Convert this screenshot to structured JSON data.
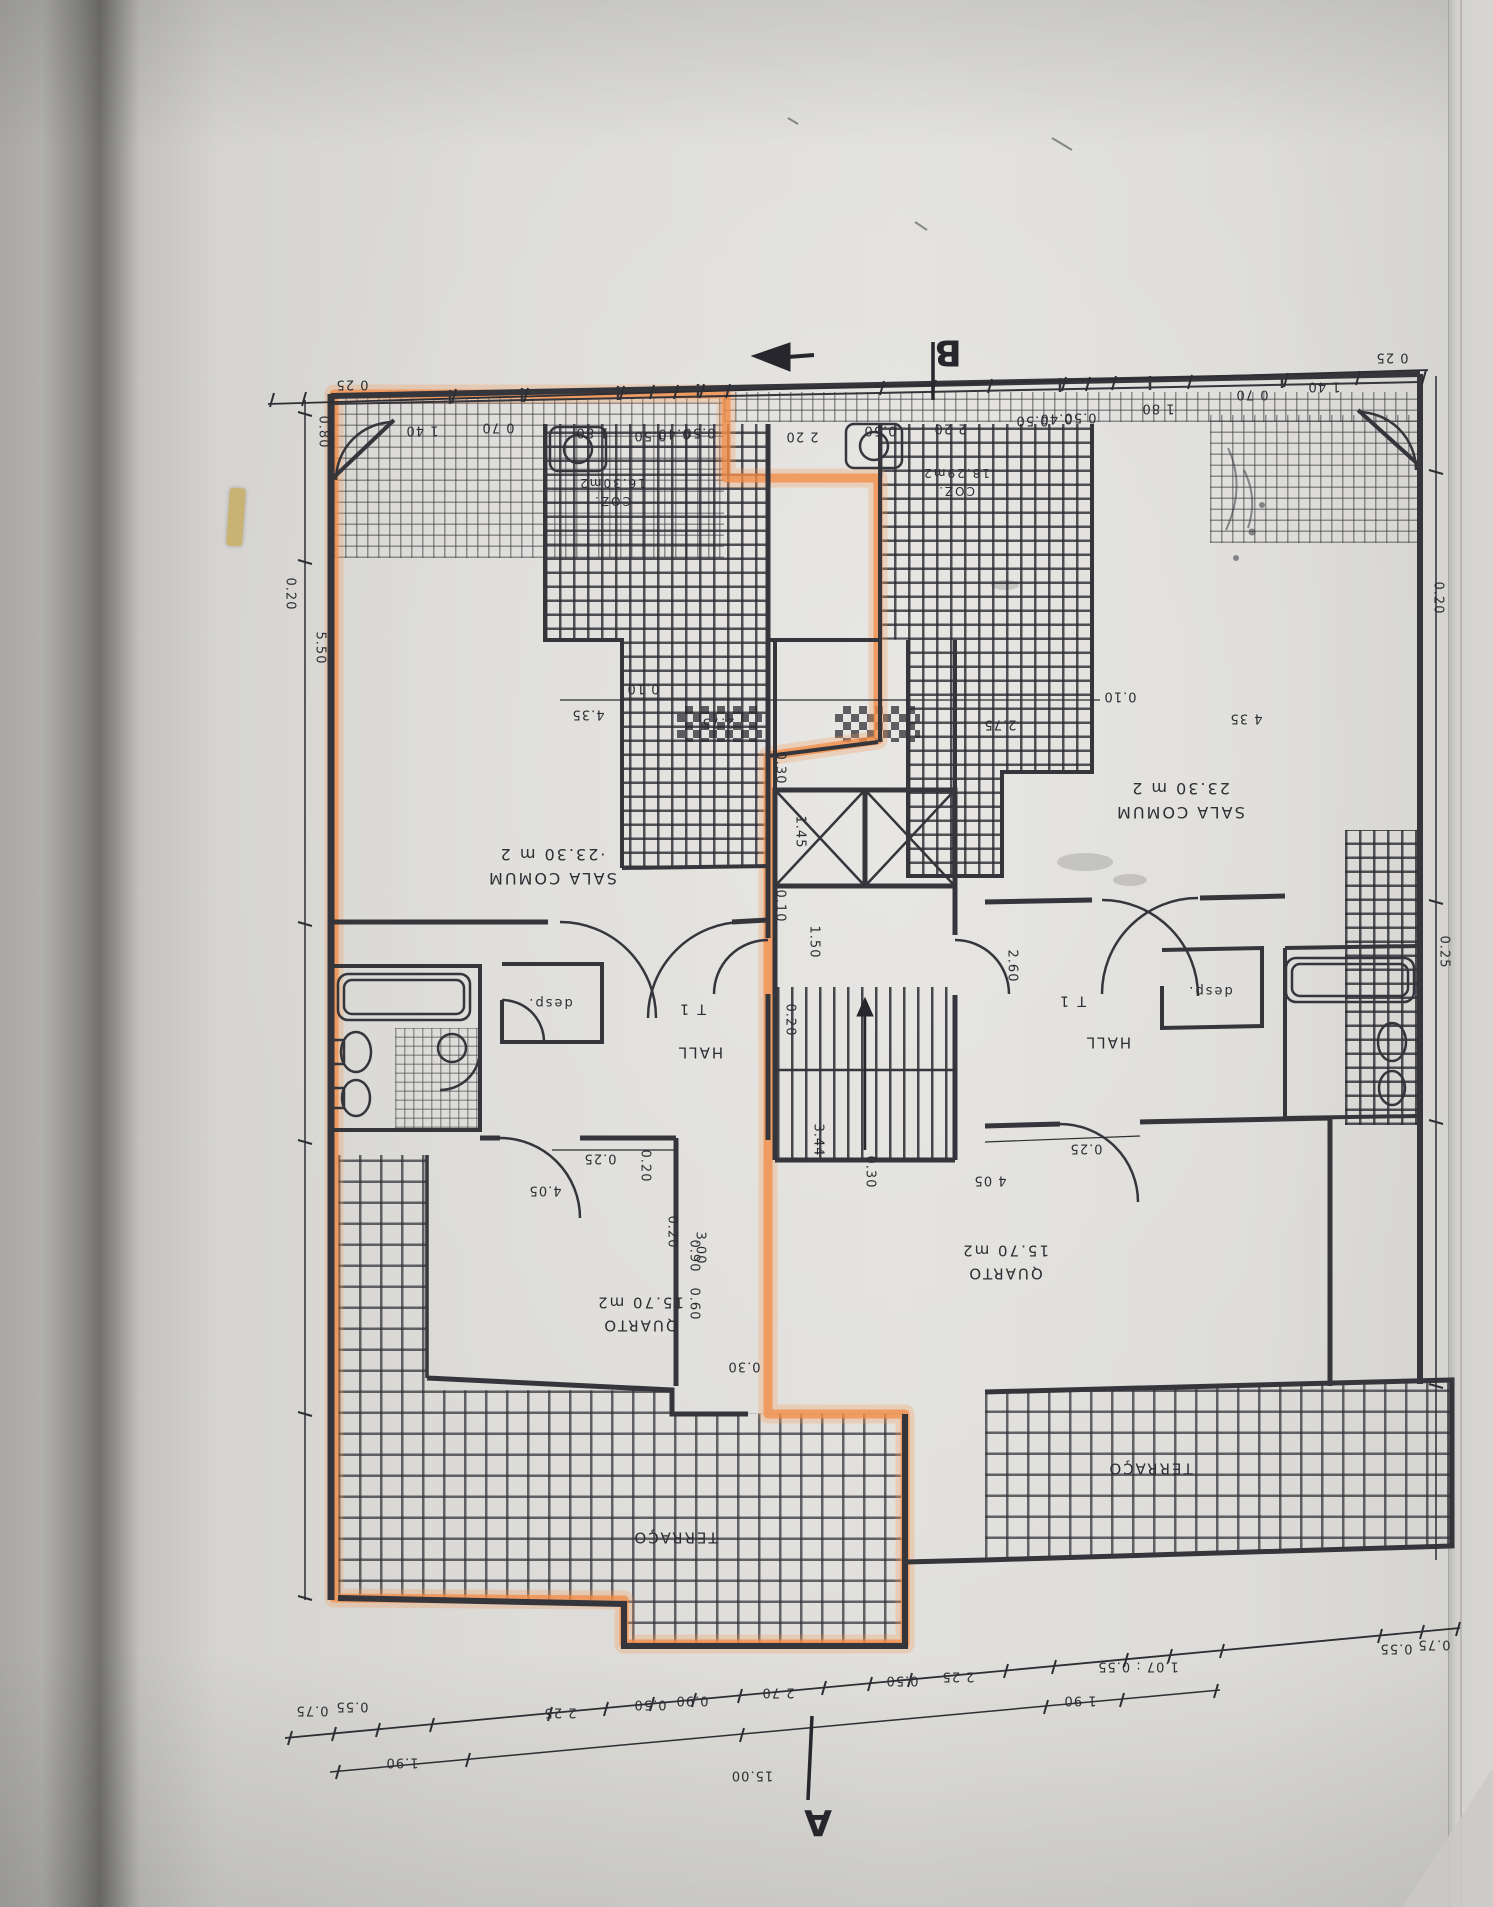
{
  "photo": {
    "ink_color": "#35353c",
    "highlight_color": "#f18b46",
    "page_color": "#dcdbd7",
    "description": "Photographed architectural floor plan page, drawing appears rotated 180 degrees, left apartment unit outlined with orange highlighter"
  },
  "plan": {
    "marker_a": "A",
    "marker_b": "B",
    "room_labels": [
      {
        "id": "room-label-sala-left",
        "lines": [
          "SALA COMUM",
          "·23.30 m 2"
        ],
        "x": 552,
        "y": 866,
        "fs": 16
      },
      {
        "id": "room-label-sala-right",
        "lines": [
          "SALA COMUM",
          "23.30 m 2"
        ],
        "x": 1180,
        "y": 800,
        "fs": 16
      },
      {
        "id": "room-label-coz-left",
        "lines": [
          "COZ.",
          "16.30m2"
        ],
        "x": 612,
        "y": 492,
        "fs": 12
      },
      {
        "id": "room-label-coz-right",
        "lines": [
          "COZ.",
          "18.29m2"
        ],
        "x": 956,
        "y": 482,
        "fs": 12
      },
      {
        "id": "room-label-quarto-left",
        "lines": [
          "QUARTO",
          "15.70 m2"
        ],
        "x": 640,
        "y": 1314,
        "fs": 15
      },
      {
        "id": "room-label-quarto-right",
        "lines": [
          "QUARTO",
          "15.70 m2"
        ],
        "x": 1005,
        "y": 1262,
        "fs": 15
      },
      {
        "id": "room-label-terraco-left",
        "lines": [
          "TERRAÇO"
        ],
        "x": 675,
        "y": 1537,
        "fs": 15
      },
      {
        "id": "room-label-terraco-right",
        "lines": [
          "TERRAÇO"
        ],
        "x": 1150,
        "y": 1468,
        "fs": 15
      },
      {
        "id": "room-label-hall-left",
        "lines": [
          "HALL"
        ],
        "x": 700,
        "y": 1052,
        "fs": 15
      },
      {
        "id": "room-label-t1-left",
        "lines": [
          "T 1"
        ],
        "x": 692,
        "y": 1008,
        "fs": 14
      },
      {
        "id": "room-label-desp-left",
        "lines": [
          "desp."
        ],
        "x": 550,
        "y": 1002,
        "fs": 13
      },
      {
        "id": "room-label-hall-right",
        "lines": [
          "HALL"
        ],
        "x": 1108,
        "y": 1042,
        "fs": 15
      },
      {
        "id": "room-label-t1-right",
        "lines": [
          "T 1"
        ],
        "x": 1072,
        "y": 1000,
        "fs": 14
      },
      {
        "id": "room-label-desp-right",
        "lines": [
          "desp."
        ],
        "x": 1210,
        "y": 990,
        "fs": 13
      }
    ],
    "dim_labels": [
      {
        "t": "0 25",
        "x": 352,
        "y": 384
      },
      {
        "t": "1 40",
        "x": 422,
        "y": 430
      },
      {
        "t": "0 70",
        "x": 498,
        "y": 427
      },
      {
        "t": "1 80",
        "x": 592,
        "y": 432
      },
      {
        "t": "0.50",
        "x": 650,
        "y": 435
      },
      {
        "t": "0.40",
        "x": 674,
        "y": 433
      },
      {
        "t": "0.50",
        "x": 699,
        "y": 432
      },
      {
        "t": "2 20",
        "x": 802,
        "y": 436
      },
      {
        "t": "0.50",
        "x": 880,
        "y": 430
      },
      {
        "t": "2 20",
        "x": 950,
        "y": 428
      },
      {
        "t": "0.50",
        "x": 1032,
        "y": 420
      },
      {
        "t": "0.40",
        "x": 1056,
        "y": 418
      },
      {
        "t": "0.50",
        "x": 1080,
        "y": 417
      },
      {
        "t": "1 80",
        "x": 1158,
        "y": 408
      },
      {
        "t": "0 70",
        "x": 1252,
        "y": 394
      },
      {
        "t": "1 40",
        "x": 1324,
        "y": 386
      },
      {
        "t": "0 25",
        "x": 1392,
        "y": 357
      },
      {
        "t": "0.80",
        "x": 323,
        "y": 432,
        "v": 1
      },
      {
        "t": "0.20",
        "x": 290,
        "y": 594,
        "v": 1
      },
      {
        "t": "5.50",
        "x": 320,
        "y": 648,
        "v": 1
      },
      {
        "t": "0.20",
        "x": 1438,
        "y": 598,
        "v": 1
      },
      {
        "t": "0.25",
        "x": 1444,
        "y": 952,
        "v": 1
      },
      {
        "t": "0.10",
        "x": 643,
        "y": 688
      },
      {
        "t": "4.35",
        "x": 588,
        "y": 714
      },
      {
        "t": "0.10",
        "x": 1120,
        "y": 696
      },
      {
        "t": "4 35",
        "x": 1246,
        "y": 718
      },
      {
        "t": "2.75",
        "x": 718,
        "y": 722
      },
      {
        "t": "2.75",
        "x": 1000,
        "y": 724
      },
      {
        "t": "0.30",
        "x": 780,
        "y": 768,
        "v": 1
      },
      {
        "t": "1.45",
        "x": 800,
        "y": 832,
        "v": 1
      },
      {
        "t": "0.10",
        "x": 780,
        "y": 906,
        "v": 1
      },
      {
        "t": "1.50",
        "x": 814,
        "y": 942,
        "v": 1
      },
      {
        "t": "0.20",
        "x": 790,
        "y": 1020,
        "v": 1
      },
      {
        "t": "2.60",
        "x": 1012,
        "y": 966,
        "v": 1
      },
      {
        "t": "3.44",
        "x": 818,
        "y": 1140,
        "v": 1
      },
      {
        "t": "3.00",
        "x": 700,
        "y": 1248,
        "v": 1
      },
      {
        "t": "0.25",
        "x": 600,
        "y": 1158
      },
      {
        "t": "4.05",
        "x": 545,
        "y": 1190
      },
      {
        "t": "0.20",
        "x": 645,
        "y": 1166,
        "v": 1
      },
      {
        "t": "0.25",
        "x": 1086,
        "y": 1148
      },
      {
        "t": "4 05",
        "x": 990,
        "y": 1180
      },
      {
        "t": "0.30",
        "x": 870,
        "y": 1172,
        "v": 1
      },
      {
        "t": "0.20",
        "x": 672,
        "y": 1232,
        "v": 1
      },
      {
        "t": "0.90",
        "x": 694,
        "y": 1256,
        "v": 1
      },
      {
        "t": "0.60",
        "x": 694,
        "y": 1304,
        "v": 1
      },
      {
        "t": "0.30",
        "x": 744,
        "y": 1366
      },
      {
        "t": "0.75",
        "x": 312,
        "y": 1710
      },
      {
        "t": "0.55",
        "x": 352,
        "y": 1706
      },
      {
        "t": "1.90",
        "x": 402,
        "y": 1762
      },
      {
        "t": "2 25",
        "x": 560,
        "y": 1712
      },
      {
        "t": "0.50",
        "x": 650,
        "y": 1704
      },
      {
        "t": "0.90",
        "x": 692,
        "y": 1700
      },
      {
        "t": "2 70",
        "x": 778,
        "y": 1692
      },
      {
        "t": "0.50",
        "x": 902,
        "y": 1680
      },
      {
        "t": "2 25",
        "x": 958,
        "y": 1676
      },
      {
        "t": "1 90",
        "x": 1080,
        "y": 1700
      },
      {
        "t": "1.07 : 0.55",
        "x": 1138,
        "y": 1666
      },
      {
        "t": "0.55",
        "x": 1396,
        "y": 1648
      },
      {
        "t": "0.75",
        "x": 1434,
        "y": 1644
      },
      {
        "t": "15.00",
        "x": 752,
        "y": 1775
      }
    ]
  }
}
